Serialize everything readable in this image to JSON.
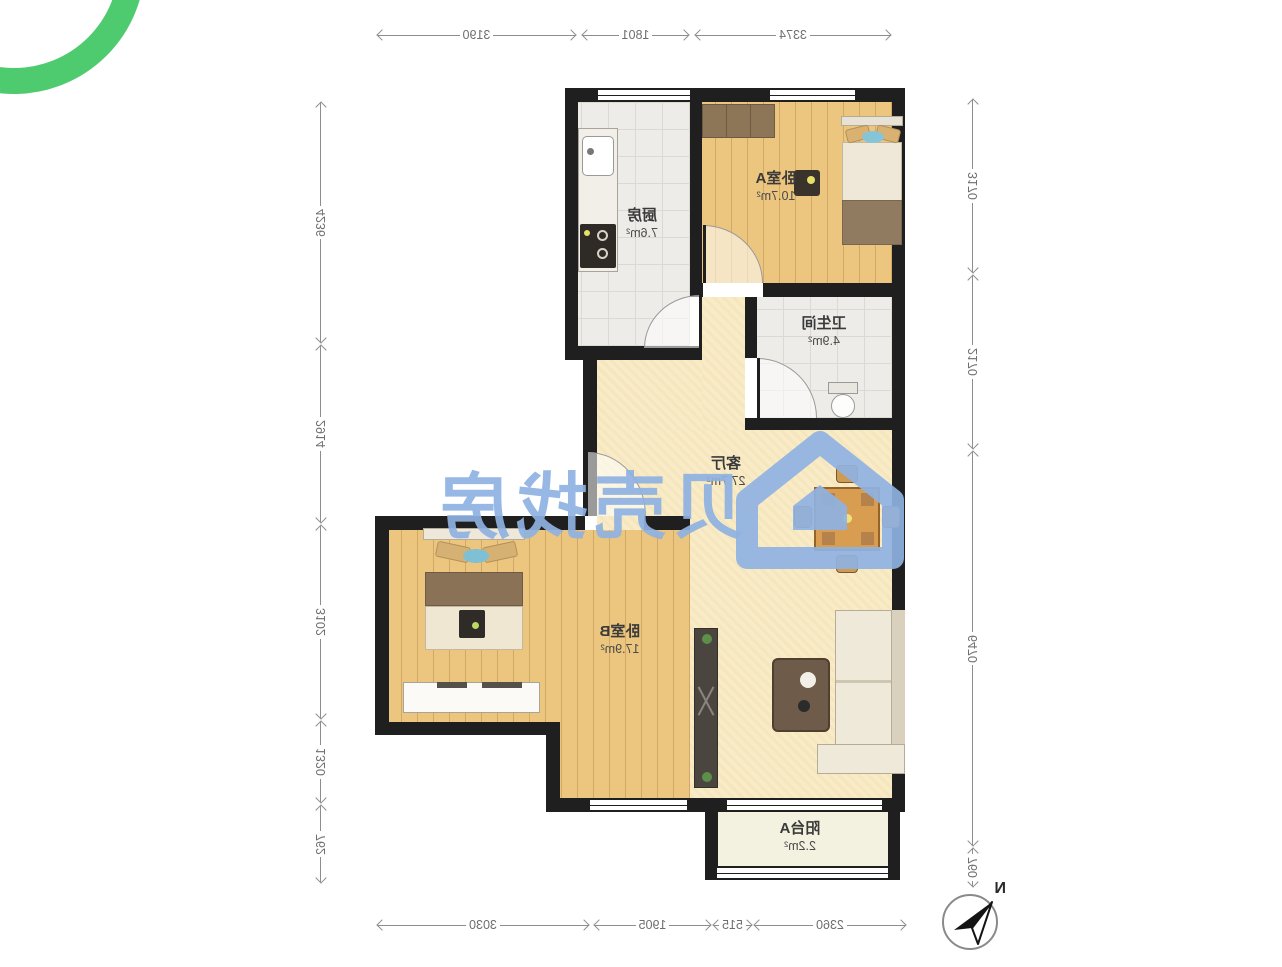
{
  "watermark": {
    "text": "贝壳找房",
    "color": "#8fb2e2"
  },
  "compass": {
    "label": "N"
  },
  "rooms": [
    {
      "id": "bedroom-a",
      "name": "卧室A",
      "area": "10.7m²"
    },
    {
      "id": "kitchen",
      "name": "厨房",
      "area": "7.6m²"
    },
    {
      "id": "bathroom",
      "name": "卫生间",
      "area": "4.9m²"
    },
    {
      "id": "living",
      "name": "客厅",
      "area": "27.7m²"
    },
    {
      "id": "bedroom-b",
      "name": "卧室B",
      "area": "17.9m²"
    },
    {
      "id": "balcony",
      "name": "阳台A",
      "area": "2.2m²"
    }
  ],
  "dimensions": {
    "top": [
      "3190",
      "1801",
      "3374"
    ],
    "bottom": [
      "3030",
      "1905",
      "515",
      "2360"
    ],
    "left_column": [
      "4236",
      "2914",
      "3102",
      "1320",
      "762"
    ],
    "right_column": [
      "3170",
      "2170",
      "6470",
      "760"
    ]
  },
  "colors": {
    "wall": "#1f1f1f",
    "wood_floor": "#ecc67f",
    "tile_floor": "#edece8",
    "living_floor": "#f8ebc6",
    "balcony_floor": "#f3f2e0",
    "watermark_blue": "#8fb2e2",
    "logo_green": "#4ecb6f",
    "dimension_gray": "#6e6e6e"
  }
}
